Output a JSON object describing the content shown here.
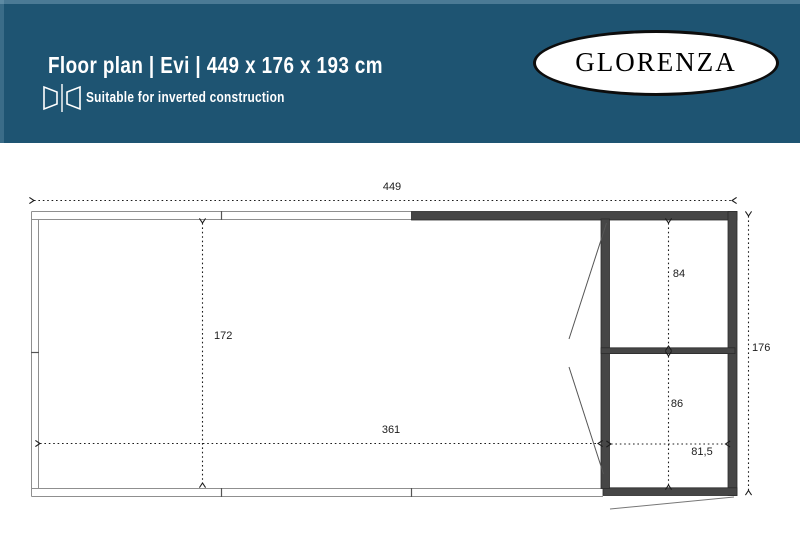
{
  "header": {
    "title": "Floor plan | Evi | 449 x 176 x 193 cm",
    "subtitle": "Suitable for inverted construction",
    "logo_text": "GLORENZA",
    "bg_color": "#1e5472"
  },
  "plan": {
    "dimensions": {
      "overall_width": "449",
      "overall_depth": "176",
      "canopy_depth": "172",
      "canopy_width": "361",
      "room_upper_depth": "84",
      "room_lower_depth": "86",
      "room_width": "81,5"
    },
    "wall_color": "#464646",
    "thin_line_color": "#8f8f8f",
    "dim_line_color": "#222222"
  }
}
